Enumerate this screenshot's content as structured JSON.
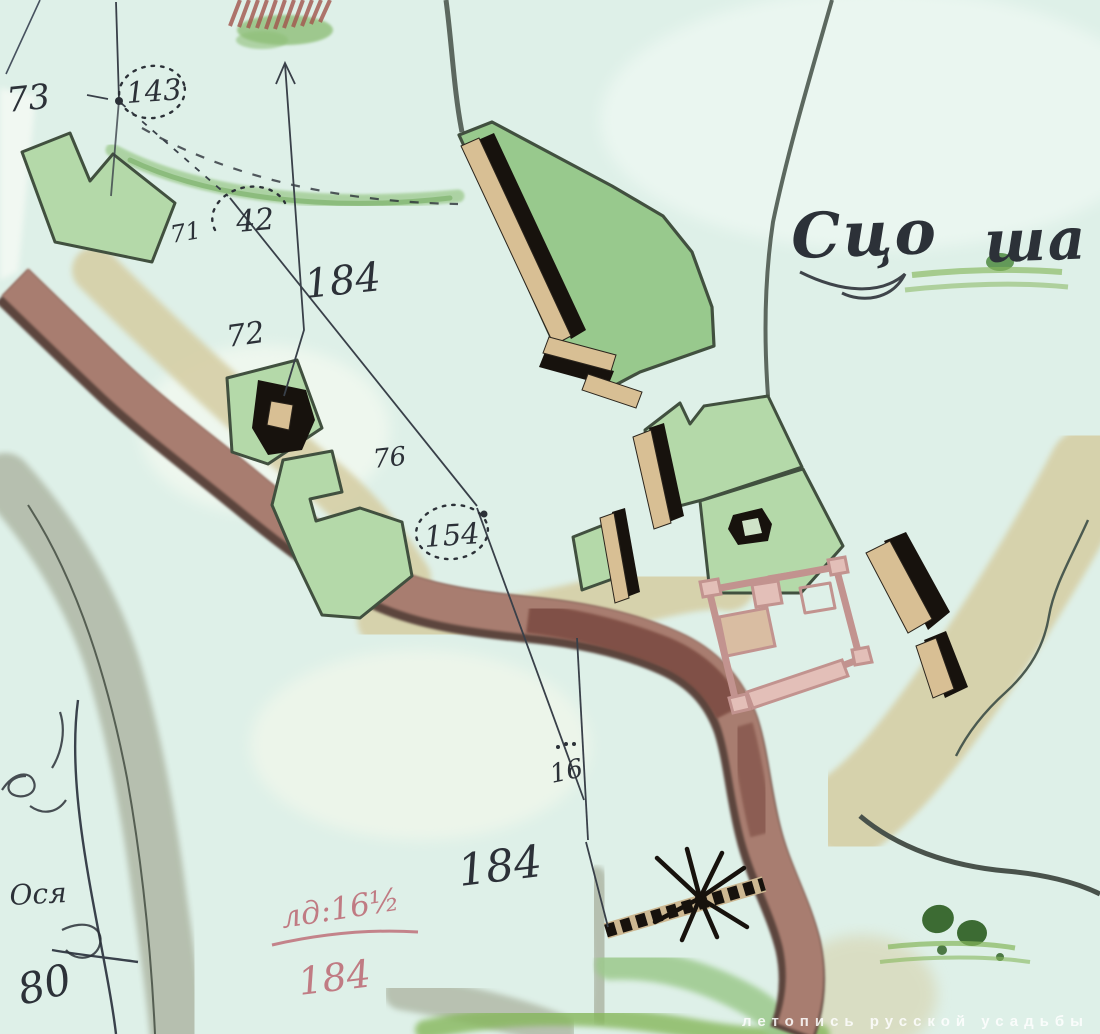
{
  "map": {
    "labels": {
      "plot_73": "73",
      "station_143": "143",
      "mark_71": "71",
      "mark_42": "42",
      "area_184_upper": "184",
      "mark_72": "72",
      "mark_76": "76",
      "station_154": "154",
      "mark_16": "16",
      "area_184_lower": "184",
      "settlement_part1": "Сцо",
      "settlement_part2": "ша",
      "corner_word": "Ося",
      "corner_number": "80",
      "red_note_numerator": "лд:16½",
      "red_note_denominator": "184"
    },
    "watermark": "летопись русской усадьбы"
  },
  "colors": {
    "paper": "#def0e8",
    "paper-light": "#eef8f1",
    "plot-green": "#b4d9a9",
    "plot-green-dark": "#98c98d",
    "outline-dark": "#41503f",
    "river-brown": "#a87d6f",
    "river-dark": "#7a4a40",
    "river-edge": "#5c443c",
    "road-tan": "#d6cfa6",
    "ravine-gray": "#b4bdac",
    "gully-green": "#9cc98c",
    "grass-green": "#86b75c",
    "tree-green": "#3c6b33",
    "ink": "#2c3138",
    "survey": "#394049",
    "building-tan": "#d8bf94",
    "building-black": "#17120d",
    "pink": "#c2938f",
    "pink-light": "#e3bfb8",
    "red-note": "#b95f6b",
    "watermark": "#ffffff"
  }
}
